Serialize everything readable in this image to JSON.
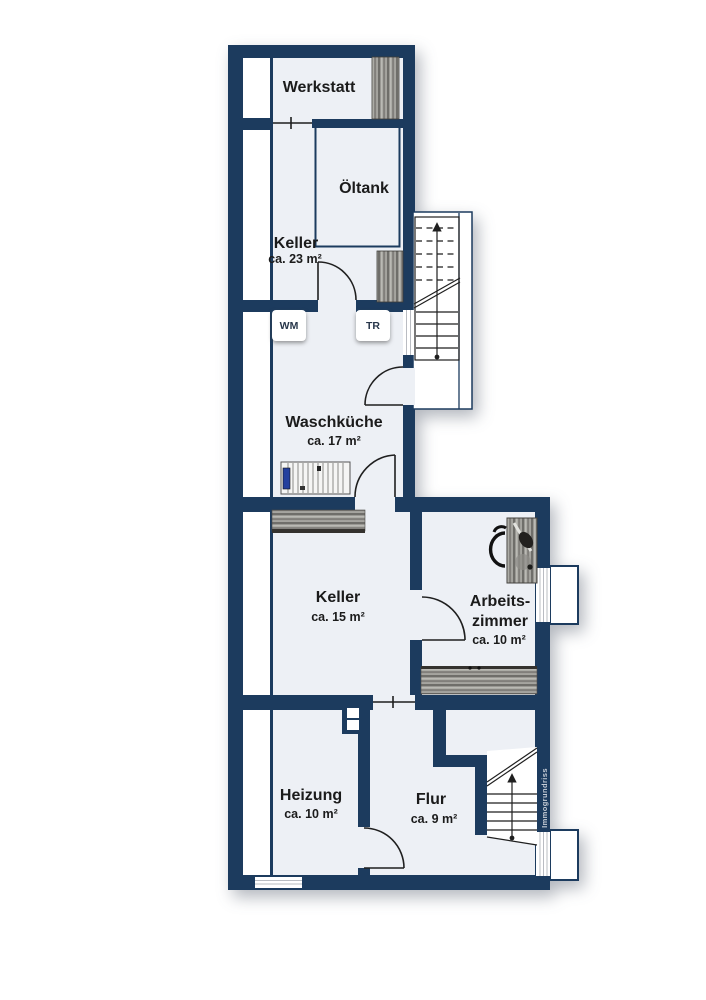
{
  "watermark": "Immogrundriss",
  "rooms": {
    "werkstatt": {
      "name": "Werkstatt"
    },
    "oeltank": {
      "name": "Öltank"
    },
    "keller_23": {
      "name": "Keller",
      "size": "ca. 23 m²"
    },
    "waschkueche": {
      "name": "Waschküche",
      "size": "ca. 17 m²"
    },
    "keller_15": {
      "name": "Keller",
      "size": "ca. 15 m²"
    },
    "arbeitszimmer": {
      "name_line1": "Arbeits-",
      "name_line2": "zimmer",
      "size": "ca. 10 m²"
    },
    "heizung": {
      "name": "Heizung",
      "size": "ca. 10 m²"
    },
    "flur": {
      "name": "Flur",
      "size": "ca. 9 m²"
    }
  },
  "appliances": {
    "washing_machine_label": "WM",
    "dryer_label": "TR"
  },
  "colors": {
    "wall": "#1c3b5e",
    "floor": "#edf0f5",
    "paper": "#ffffff",
    "stair_lines": "#1f1f1f",
    "watermark_text": "#c7cdd6",
    "rack_accent_blue": "#24409e"
  }
}
